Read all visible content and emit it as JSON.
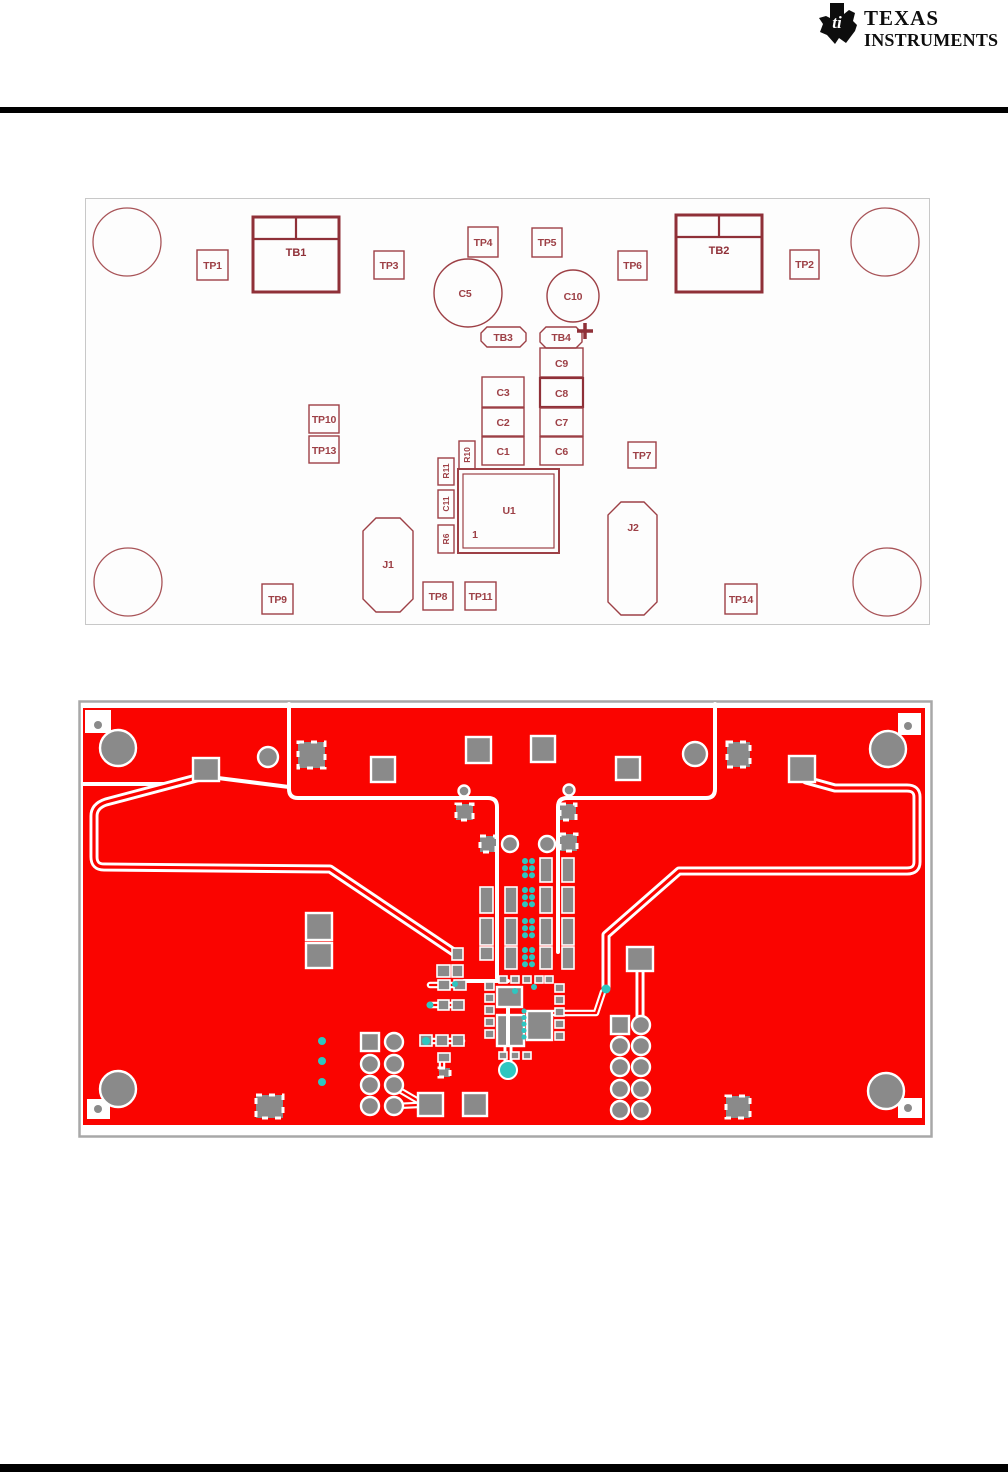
{
  "logo": {
    "brand_top": "TEXAS",
    "brand_bottom": "INSTRUMENTS",
    "bug_text": "ti"
  },
  "figure_silkscreen": {
    "background": "#fdfdfd",
    "border": "#c8c8c8",
    "ink": "#9d4046",
    "ink_bold": "#8f3038",
    "labels": {
      "tp1": "TP1",
      "tp2": "TP2",
      "tp3": "TP3",
      "tp4": "TP4",
      "tp5": "TP5",
      "tp6": "TP6",
      "tp7": "TP7",
      "tp8": "TP8",
      "tp9": "TP9",
      "tp10": "TP10",
      "tp11": "TP11",
      "tp13": "TP13",
      "tp14": "TP14",
      "tb1": "TB1",
      "tb2": "TB2",
      "tb3": "TB3",
      "tb4": "TB4",
      "c1": "C1",
      "c2": "C2",
      "c3": "C3",
      "c5": "C5",
      "c6": "C6",
      "c7": "C7",
      "c8": "C8",
      "c9": "C9",
      "c10": "C10",
      "c11": "C11",
      "r6": "R6",
      "r10": "R10",
      "r11": "R11",
      "u1": "U1",
      "u1_pin1": "1",
      "j1": "J1",
      "j2": "J2",
      "plus_mark": "+"
    }
  },
  "figure_copper": {
    "board_red": "#fa0400",
    "pad_gray": "#8a8a8a",
    "via_cyan": "#2ec6c0",
    "border_gray": "#a8a8a8"
  }
}
